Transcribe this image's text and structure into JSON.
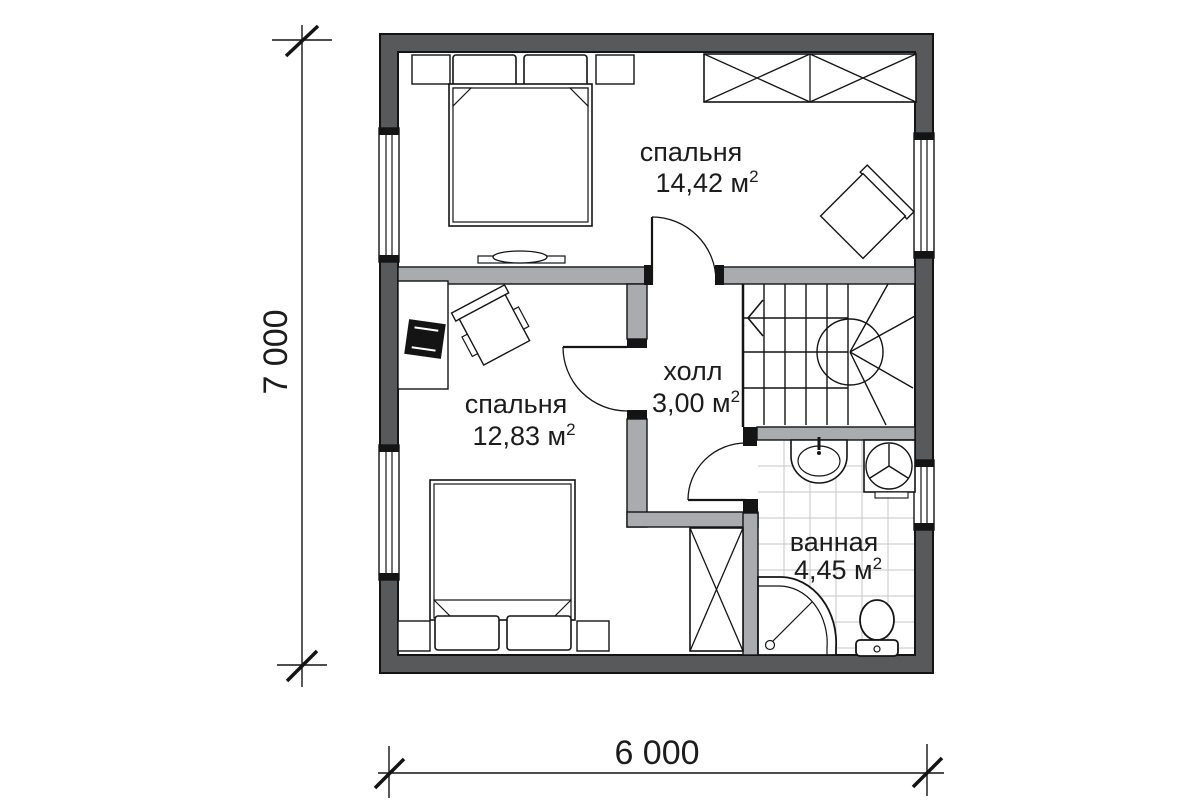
{
  "plan": {
    "title_type": "floor-plan",
    "rooms": [
      {
        "id": "bedroom-top",
        "label": "спальня",
        "area_value": "14,42 м",
        "area_sup": "2"
      },
      {
        "id": "bedroom-bottom",
        "label": "спальня",
        "area_value": "12,83 м",
        "area_sup": "2"
      },
      {
        "id": "hall",
        "label": "холл",
        "area_value": "3,00 м",
        "area_sup": "2"
      },
      {
        "id": "bathroom",
        "label": "ванная",
        "area_value": "4,45 м",
        "area_sup": "2"
      }
    ],
    "dimensions": {
      "height_label": "7 000",
      "width_label": "6 000"
    },
    "furniture_icons": [
      "double-bed",
      "nightstand",
      "pillow",
      "wardrobe-crossed",
      "armchair",
      "desk",
      "desk-chair",
      "computer",
      "tv-console",
      "stairs-winder",
      "sink",
      "washing-machine",
      "shower-corner",
      "toilet"
    ],
    "colors": {
      "outer_wall": "#58595b",
      "inner_wall": "#a9abae",
      "line": "#141414",
      "tile_line": "#c6c6c6",
      "floor": "#ffffff"
    }
  }
}
